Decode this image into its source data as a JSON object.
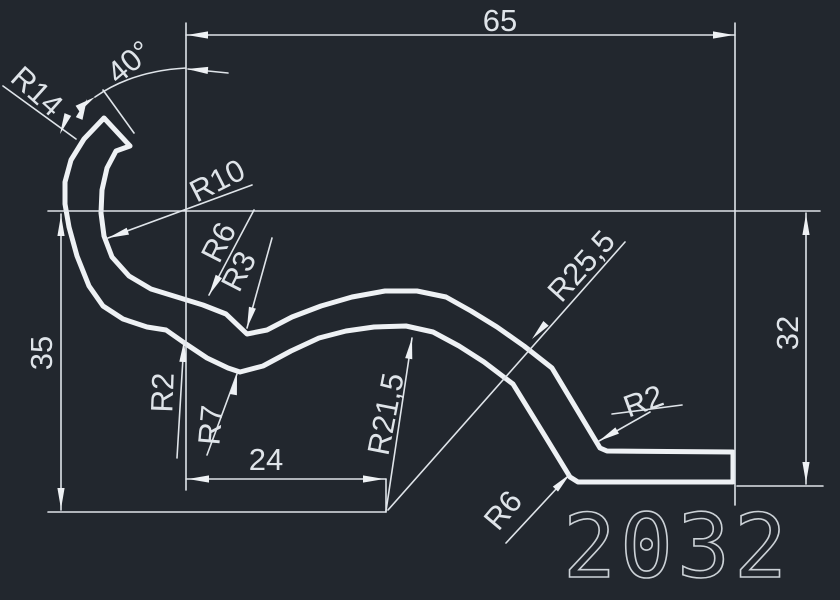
{
  "drawing": {
    "type": "cad-profile-drawing",
    "part_number": "2032",
    "colors": {
      "background": "#22272e",
      "line": "#eef1f4",
      "dim_line": "#dfe4e9"
    },
    "labels": {
      "dim_65": "65",
      "dim_40": "40°",
      "r14": "R14",
      "r10": "R10",
      "r6_upper": "R6",
      "r3": "R3",
      "r2_left": "R2",
      "r7": "R7",
      "dim_24": "24",
      "dim_35": "35",
      "r21_5": "R21,5",
      "r25_5": "R25,5",
      "r2_right": "R2",
      "r6_lower": "R6",
      "dim_32": "32"
    },
    "dimensions": {
      "overall_width": "65",
      "end_angle": "40°",
      "height_left": "35",
      "height_right": "32",
      "center_offset": "24",
      "radii": [
        "R14",
        "R10",
        "R6",
        "R3",
        "R2",
        "R7",
        "R21,5",
        "R25,5",
        "R2",
        "R6"
      ]
    }
  }
}
